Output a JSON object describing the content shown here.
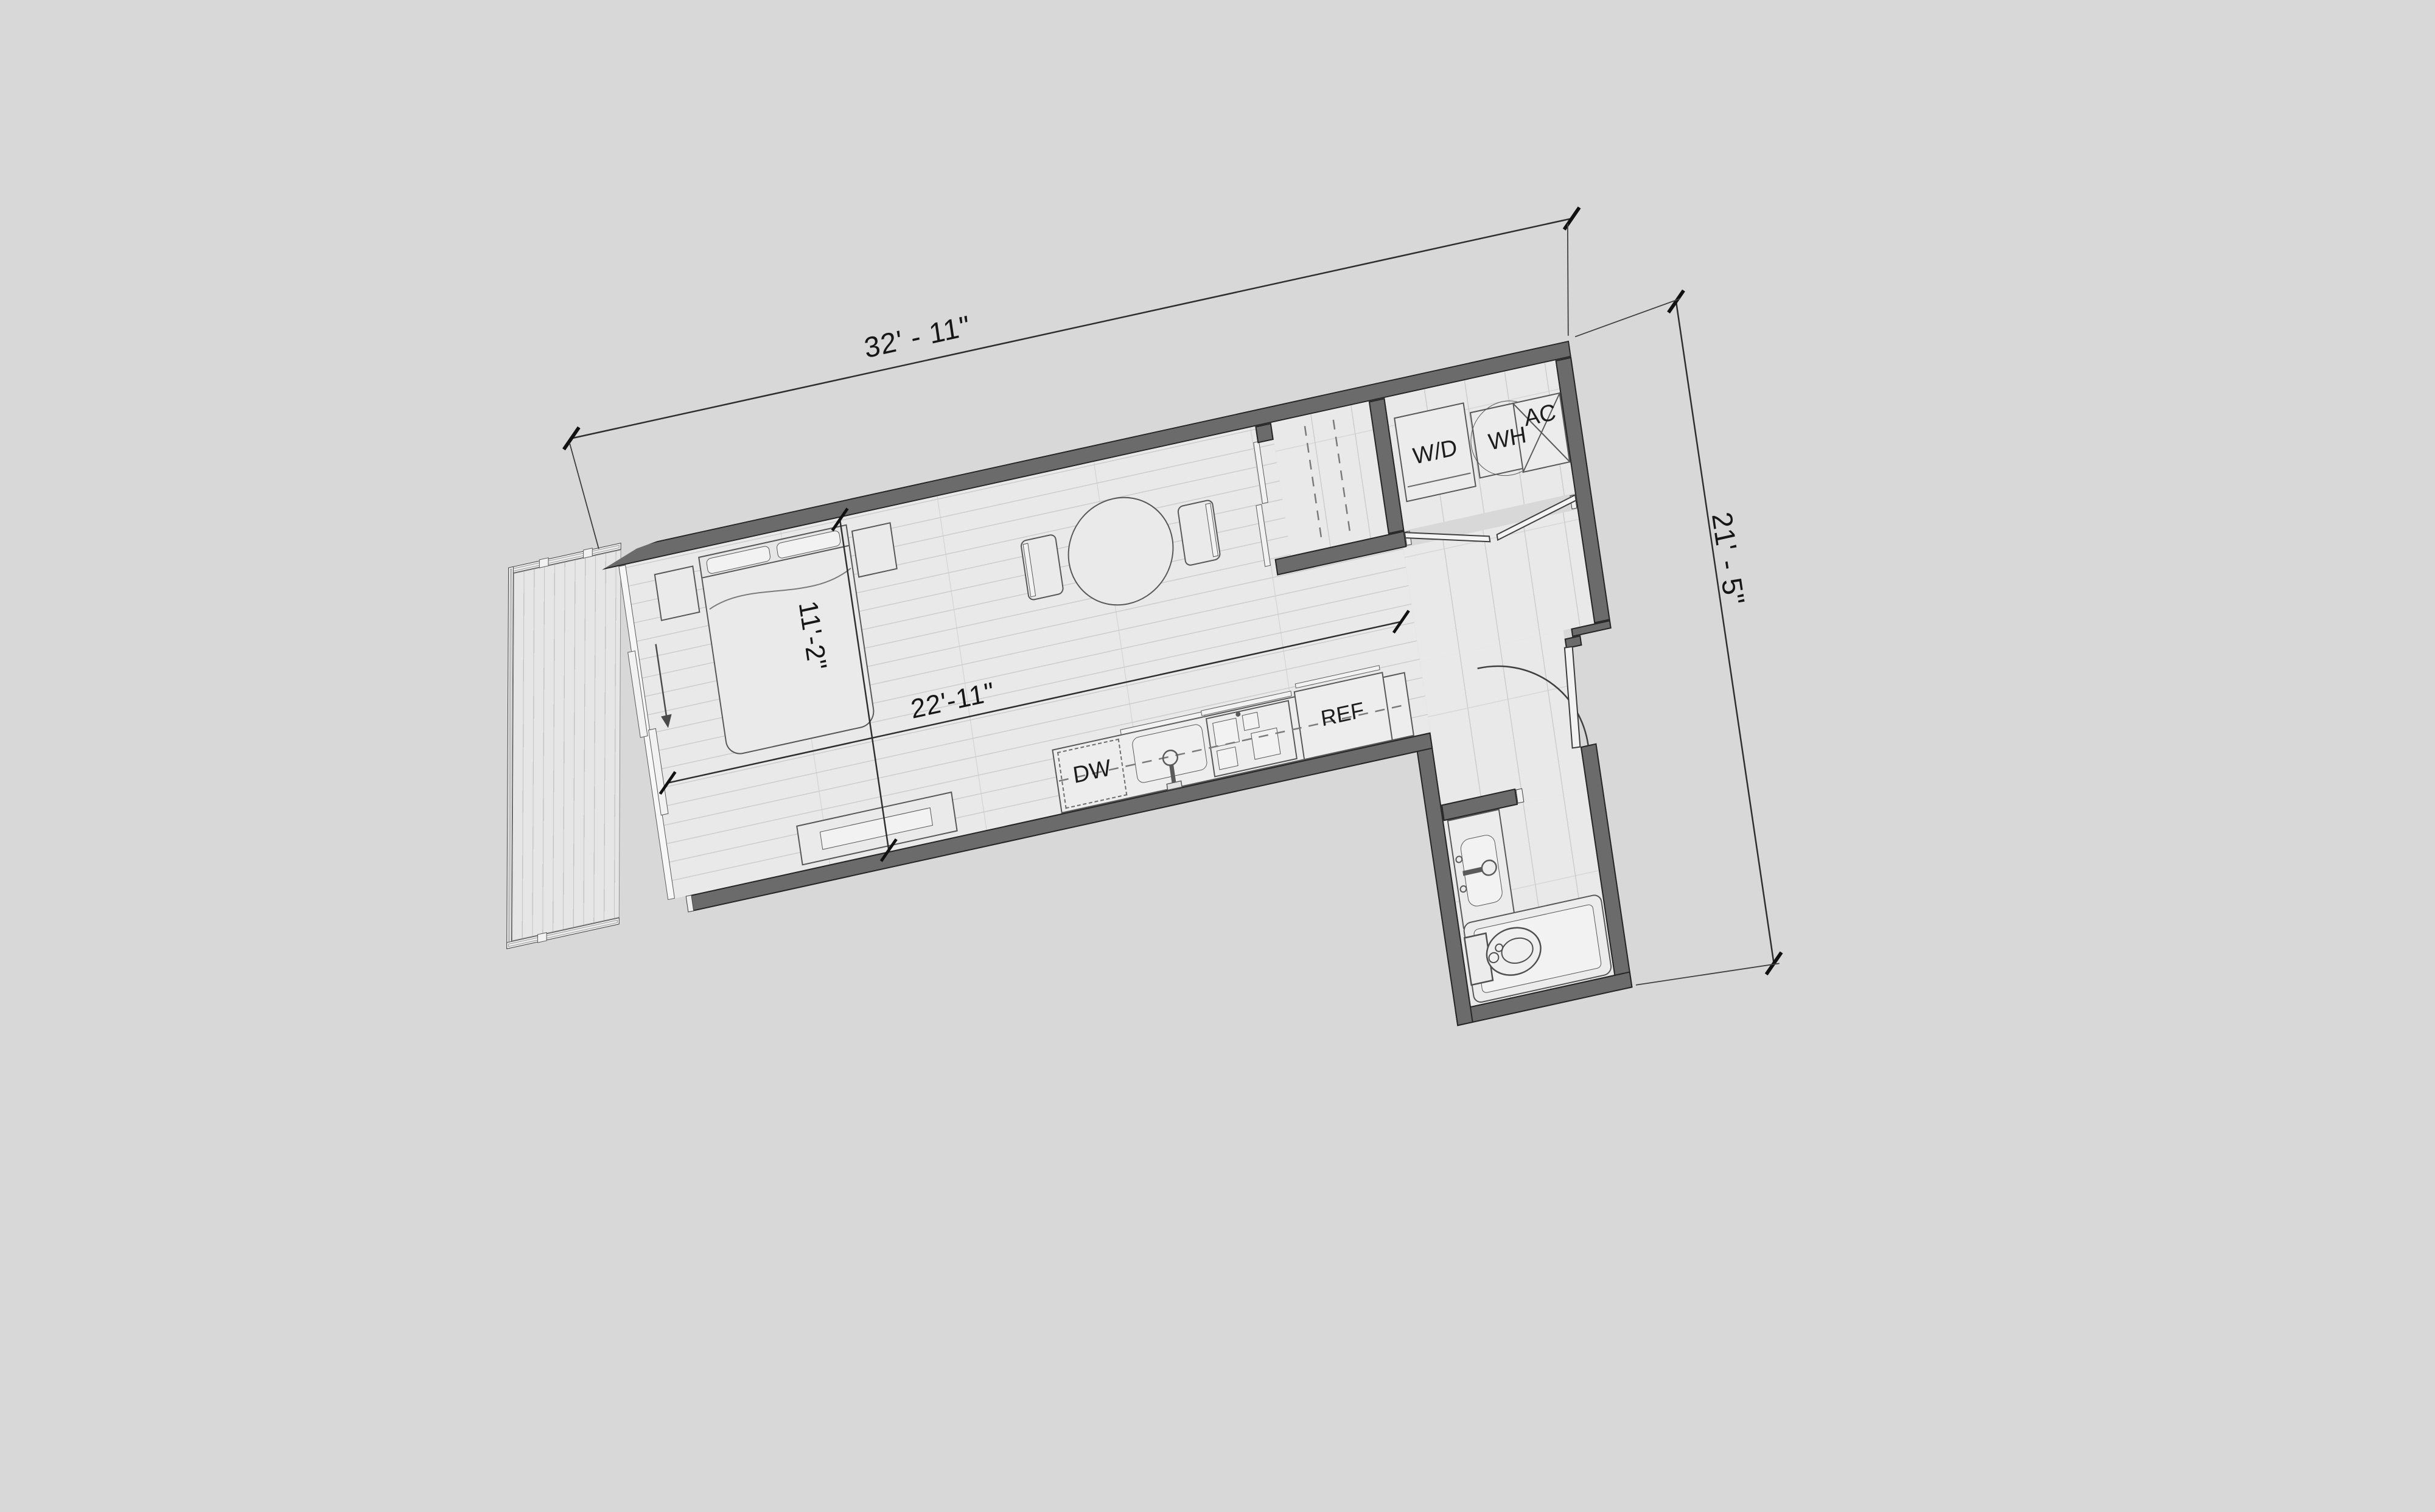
{
  "page": {
    "title": "Studio apartment floor plan",
    "background_color": "#d8d8d8"
  },
  "dimensions": {
    "overall_width": "32' - 11\"",
    "overall_height": "21' - 5\"",
    "living_length": "22'-11\"",
    "living_width": "11'-2\""
  },
  "appliance_labels": {
    "washer_dryer": "W/D",
    "water_heater": "WH",
    "air_conditioner": "AC",
    "refrigerator": "REF",
    "dishwasher": "DW"
  },
  "colors": {
    "wall_fill": "#6b6b6b",
    "wall_outline": "#262626",
    "floor": "#e9e9e9",
    "floor_lines": "#cdcdcd",
    "background": "#d8d8d8",
    "deck": "#e6e6e6",
    "drawing_lines": "#575757",
    "text": "#1c1c1c"
  }
}
